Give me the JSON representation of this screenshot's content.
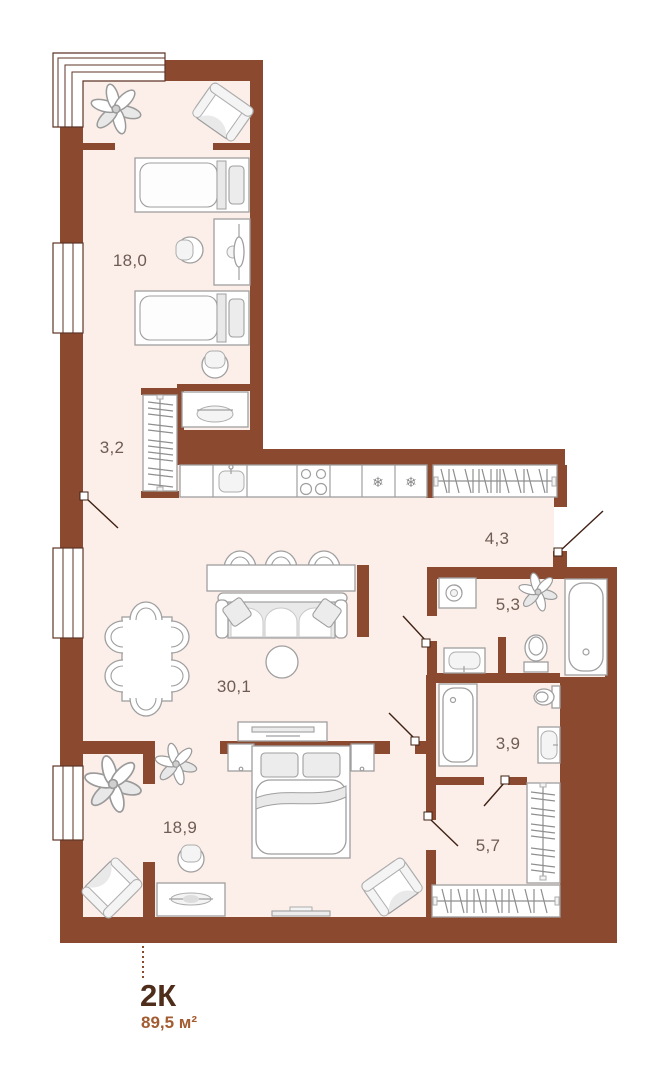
{
  "plan": {
    "type": "apartment-floor-plan",
    "legend": {
      "plan_type": "2К",
      "total_area": "89,5 м²"
    },
    "rooms": [
      {
        "id": "bedroom-top",
        "label": "18,0"
      },
      {
        "id": "hall-top",
        "label": "3,2"
      },
      {
        "id": "entry-hall",
        "label": "4,3"
      },
      {
        "id": "bathroom-large",
        "label": "5,3"
      },
      {
        "id": "kitchen-living",
        "label": "30,1"
      },
      {
        "id": "bathroom-small",
        "label": "3,9"
      },
      {
        "id": "bedroom-bottom",
        "label": "18,9"
      },
      {
        "id": "wardrobe-hall",
        "label": "5,7"
      }
    ],
    "icons": {
      "fridge": "❄",
      "freezer": "❄"
    },
    "palette": {
      "wall": "#8B4A2F",
      "floor": "#FCEFE9",
      "furniture_outline": "#9f9f9f",
      "room_label_text": "#6f5d55",
      "plan_type_text": "#4f2d1b",
      "total_area_text": "#a35c31",
      "door_swing_line": "#3f2114",
      "window_frame": "#5d3527"
    }
  }
}
